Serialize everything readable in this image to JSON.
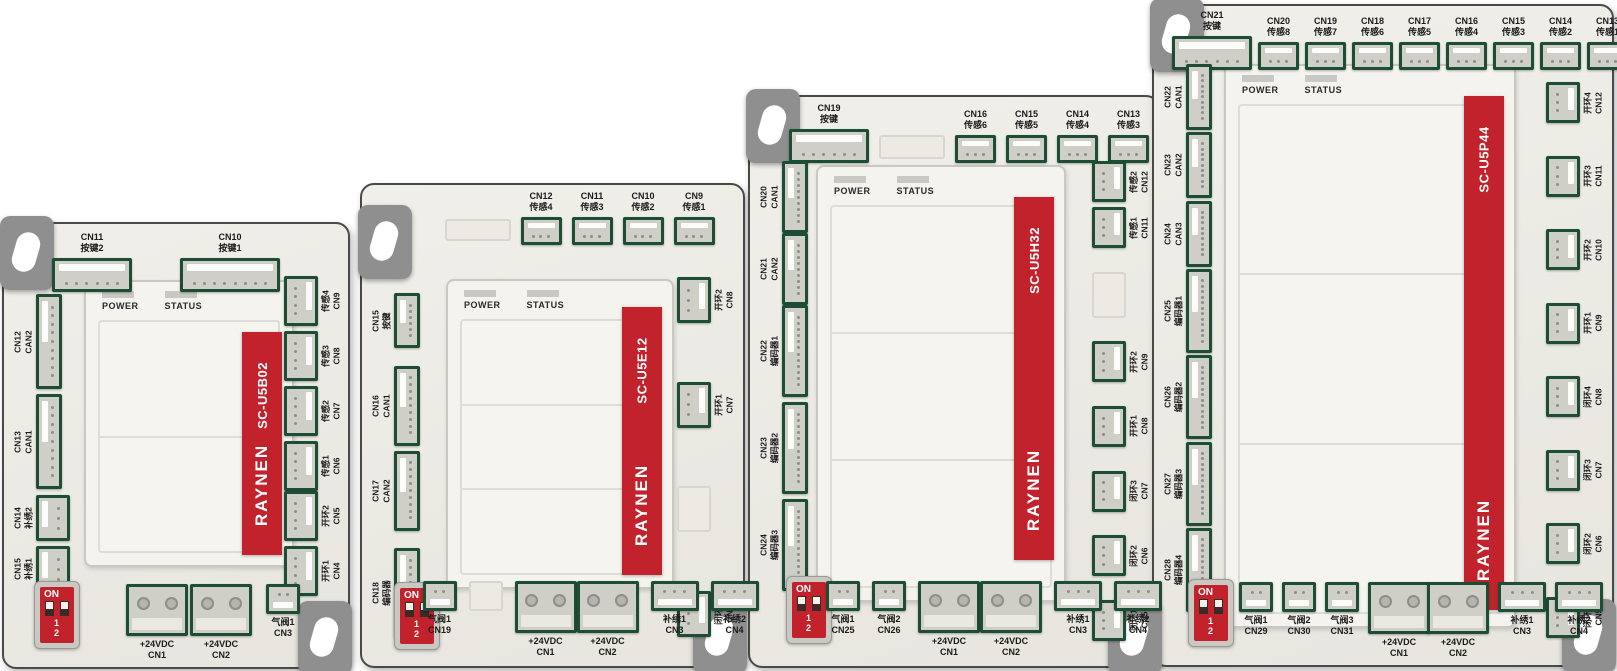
{
  "brand": "RAYNEN",
  "panel_labels": {
    "power": "POWER",
    "status": "STATUS"
  },
  "dip": {
    "on": "ON",
    "nums": "1 2"
  },
  "colors": {
    "accent_red": "#c1222b",
    "connector_green": "#1d4d33",
    "board_body": "#edece6",
    "tab_gray": "#8f8f8f"
  },
  "boards": [
    {
      "id": "b1",
      "model": "SC-U5B02",
      "cells": 2,
      "top": [
        {
          "cn": "CN11",
          "fn": "按键2",
          "t": "h",
          "p": 6
        },
        {
          "cn": "CN10",
          "fn": "按键1",
          "t": "h",
          "p": 8
        }
      ],
      "left": [
        [
          {
            "cn": "CN12",
            "fn": "CAN2",
            "t": "v",
            "p": 9,
            "h": 95
          },
          {
            "cn": "CN13",
            "fn": "CAN1",
            "t": "v",
            "p": 9,
            "h": 95
          }
        ],
        [
          {
            "cn": "CN14",
            "fn": "补绣2",
            "t": "vs",
            "p": 3,
            "h": 46
          },
          {
            "cn": "CN15",
            "fn": "补绣1",
            "t": "vs",
            "p": 3,
            "h": 46
          }
        ]
      ],
      "right": [
        [
          {
            "cn": "CN9",
            "fn": "传感4",
            "t": "vs",
            "p": 4
          },
          {
            "cn": "CN8",
            "fn": "传感3",
            "t": "vs",
            "p": 4
          },
          {
            "cn": "CN7",
            "fn": "传感2",
            "t": "vs",
            "p": 4
          },
          {
            "cn": "CN6",
            "fn": "传感1",
            "t": "vs",
            "p": 4
          }
        ],
        [
          {
            "cn": "CN5",
            "fn": "开环2",
            "t": "vs",
            "p": 4
          },
          {
            "cn": "CN4",
            "fn": "开环1",
            "t": "vs",
            "p": 4
          }
        ]
      ],
      "bottom": [
        {
          "cn": "CN1",
          "fn": "+24VDC",
          "t": "pwr"
        },
        {
          "cn": "CN2",
          "fn": "+24VDC",
          "t": "pwr"
        },
        {
          "cn": "CN3",
          "fn": "气阀1",
          "t": "sm",
          "p": 2
        }
      ]
    },
    {
      "id": "b2",
      "model": "SC-U5E12",
      "cells": 3,
      "top": [
        {
          "t": "blank",
          "w": 66,
          "h": 22
        },
        {
          "cn": "CN12",
          "fn": "传感4",
          "t": "hs",
          "p": 3
        },
        {
          "cn": "CN11",
          "fn": "传感3",
          "t": "hs",
          "p": 3
        },
        {
          "cn": "CN10",
          "fn": "传感2",
          "t": "hs",
          "p": 3
        },
        {
          "cn": "CN9",
          "fn": "传感1",
          "t": "hs",
          "p": 3
        }
      ],
      "left": [
        [
          {
            "cn": "CN15",
            "fn": "按键",
            "t": "v",
            "p": 6,
            "h": 55
          }
        ],
        [
          {
            "cn": "CN16",
            "fn": "CAN1",
            "t": "v",
            "p": 9,
            "h": 80
          },
          {
            "cn": "CN17",
            "fn": "CAN2",
            "t": "v",
            "p": 9,
            "h": 80
          }
        ],
        [
          {
            "cn": "CN18",
            "fn": "编码器",
            "t": "v",
            "p": 10,
            "h": 90
          }
        ]
      ],
      "right": [
        [
          {
            "cn": "CN8",
            "fn": "开环2",
            "t": "vs",
            "p": 3,
            "h": 46
          }
        ],
        [
          {
            "cn": "CN7",
            "fn": "开环1",
            "t": "vs",
            "p": 3,
            "h": 46
          }
        ],
        [
          {
            "t": "blank",
            "w": 34,
            "h": 46
          }
        ],
        [
          {
            "cn": "CN5",
            "fn": "闭环1",
            "t": "vs",
            "p": 3,
            "h": 46
          }
        ]
      ],
      "bottom": [
        {
          "cn": "CN19",
          "fn": "气阀1",
          "t": "sm",
          "p": 2
        },
        {
          "t": "blank",
          "w": 34,
          "h": 30
        },
        {
          "cn": "CN1",
          "fn": "+24VDC",
          "t": "pwr"
        },
        {
          "cn": "CN2",
          "fn": "+24VDC",
          "t": "pwr"
        },
        {
          "cn": "CN3",
          "fn": "补绣1",
          "t": "sm",
          "p": 3
        },
        {
          "cn": "CN4",
          "fn": "补绣2",
          "t": "sm",
          "p": 3
        }
      ]
    },
    {
      "id": "b3",
      "model": "SC-U5H32",
      "cells": 3,
      "top": [
        {
          "cn": "CN19",
          "fn": "按键",
          "t": "h",
          "p": 6
        },
        {
          "t": "blank",
          "w": 66,
          "h": 24
        },
        {
          "cn": "CN16",
          "fn": "传感6",
          "t": "hs",
          "p": 3
        },
        {
          "cn": "CN15",
          "fn": "传感5",
          "t": "hs",
          "p": 3
        },
        {
          "cn": "CN14",
          "fn": "传感4",
          "t": "hs",
          "p": 3
        },
        {
          "cn": "CN13",
          "fn": "传感3",
          "t": "hs",
          "p": 3
        }
      ],
      "left": [
        [
          {
            "cn": "CN20",
            "fn": "CAN1",
            "t": "v",
            "p": 9,
            "h": 72
          }
        ],
        [
          {
            "cn": "CN21",
            "fn": "CAN2",
            "t": "v",
            "p": 9,
            "h": 72
          }
        ],
        [
          {
            "cn": "CN22",
            "fn": "编码器1",
            "t": "v",
            "p": 12,
            "h": 92
          },
          {
            "cn": "CN23",
            "fn": "编码器2",
            "t": "v",
            "p": 12,
            "h": 92
          },
          {
            "cn": "CN24",
            "fn": "编码器3",
            "t": "v",
            "p": 12,
            "h": 92
          }
        ]
      ],
      "right": [
        [
          {
            "cn": "CN12",
            "fn": "传感2",
            "t": "vs",
            "p": 3
          },
          {
            "cn": "CN11",
            "fn": "传感1",
            "t": "vs",
            "p": 3
          }
        ],
        [
          {
            "t": "blank",
            "w": 34,
            "h": 46
          }
        ],
        [
          {
            "cn": "CN9",
            "fn": "开环2",
            "t": "vs",
            "p": 3
          }
        ],
        [
          {
            "cn": "CN8",
            "fn": "开环1",
            "t": "vs",
            "p": 3
          }
        ],
        [
          {
            "cn": "CN7",
            "fn": "闭环3",
            "t": "vs",
            "p": 3
          }
        ],
        [
          {
            "cn": "CN6",
            "fn": "闭环2",
            "t": "vs",
            "p": 3
          }
        ],
        [
          {
            "cn": "CN5",
            "fn": "闭环1",
            "t": "vs",
            "p": 3
          }
        ]
      ],
      "bottom": [
        {
          "cn": "CN25",
          "fn": "气阀1",
          "t": "sm",
          "p": 2
        },
        {
          "cn": "CN26",
          "fn": "气阀2",
          "t": "sm",
          "p": 2
        },
        {
          "cn": "CN1",
          "fn": "+24VDC",
          "t": "pwr"
        },
        {
          "cn": "CN2",
          "fn": "+24VDC",
          "t": "pwr"
        },
        {
          "cn": "CN3",
          "fn": "补绣1",
          "t": "sm",
          "p": 3
        },
        {
          "cn": "CN4",
          "fn": "补绣2",
          "t": "sm",
          "p": 3
        }
      ]
    },
    {
      "id": "b4",
      "model": "SC-U5P44",
      "cells": 3,
      "top": [
        {
          "cn": "CN21",
          "fn": "按键",
          "t": "h",
          "p": 6
        },
        {
          "cn": "CN20",
          "fn": "传感8",
          "t": "hs",
          "p": 3
        },
        {
          "cn": "CN19",
          "fn": "传感7",
          "t": "hs",
          "p": 3
        },
        {
          "cn": "CN18",
          "fn": "传感6",
          "t": "hs",
          "p": 3
        },
        {
          "cn": "CN17",
          "fn": "传感5",
          "t": "hs",
          "p": 3
        },
        {
          "cn": "CN16",
          "fn": "传感4",
          "t": "hs",
          "p": 3
        },
        {
          "cn": "CN15",
          "fn": "传感3",
          "t": "hs",
          "p": 3
        },
        {
          "cn": "CN14",
          "fn": "传感2",
          "t": "hs",
          "p": 3
        },
        {
          "cn": "CN13",
          "fn": "传感1",
          "t": "hs",
          "p": 3
        }
      ],
      "left": [
        [
          {
            "cn": "CN22",
            "fn": "CAN1",
            "t": "v",
            "p": 9,
            "h": 66
          }
        ],
        [
          {
            "cn": "CN23",
            "fn": "CAN2",
            "t": "v",
            "p": 9,
            "h": 66
          }
        ],
        [
          {
            "cn": "CN24",
            "fn": "CAN3",
            "t": "v",
            "p": 9,
            "h": 66
          }
        ],
        [
          {
            "cn": "CN25",
            "fn": "编码器1",
            "t": "v",
            "p": 12,
            "h": 84
          }
        ],
        [
          {
            "cn": "CN26",
            "fn": "编码器2",
            "t": "v",
            "p": 12,
            "h": 84
          }
        ],
        [
          {
            "cn": "CN27",
            "fn": "编码器3",
            "t": "v",
            "p": 12,
            "h": 84
          }
        ],
        [
          {
            "cn": "CN28",
            "fn": "编码器4",
            "t": "v",
            "p": 12,
            "h": 84
          }
        ]
      ],
      "right": [
        [
          {
            "cn": "CN12",
            "fn": "开环4",
            "t": "vs",
            "p": 3
          }
        ],
        [
          {
            "cn": "CN11",
            "fn": "开环3",
            "t": "vs",
            "p": 3
          }
        ],
        [
          {
            "cn": "CN10",
            "fn": "开环2",
            "t": "vs",
            "p": 3
          }
        ],
        [
          {
            "cn": "CN9",
            "fn": "开环1",
            "t": "vs",
            "p": 3
          }
        ],
        [
          {
            "cn": "CN8",
            "fn": "闭环4",
            "t": "vs",
            "p": 3
          }
        ],
        [
          {
            "cn": "CN7",
            "fn": "闭环3",
            "t": "vs",
            "p": 3
          }
        ],
        [
          {
            "cn": "CN6",
            "fn": "闭环2",
            "t": "vs",
            "p": 3
          }
        ],
        [
          {
            "cn": "CN5",
            "fn": "闭环1",
            "t": "vs",
            "p": 3
          }
        ]
      ],
      "bottom": [
        {
          "cn": "CN29",
          "fn": "气阀1",
          "t": "sm",
          "p": 2
        },
        {
          "cn": "CN30",
          "fn": "气阀2",
          "t": "sm",
          "p": 2
        },
        {
          "cn": "CN31",
          "fn": "气阀3",
          "t": "sm",
          "p": 2
        },
        {
          "cn": "CN1",
          "fn": "+24VDC",
          "t": "pwr"
        },
        {
          "cn": "CN2",
          "fn": "+24VDC",
          "t": "pwr"
        },
        {
          "cn": "CN3",
          "fn": "补绣1",
          "t": "sm",
          "p": 3
        },
        {
          "cn": "CN4",
          "fn": "补绣2",
          "t": "sm",
          "p": 3
        }
      ]
    }
  ]
}
